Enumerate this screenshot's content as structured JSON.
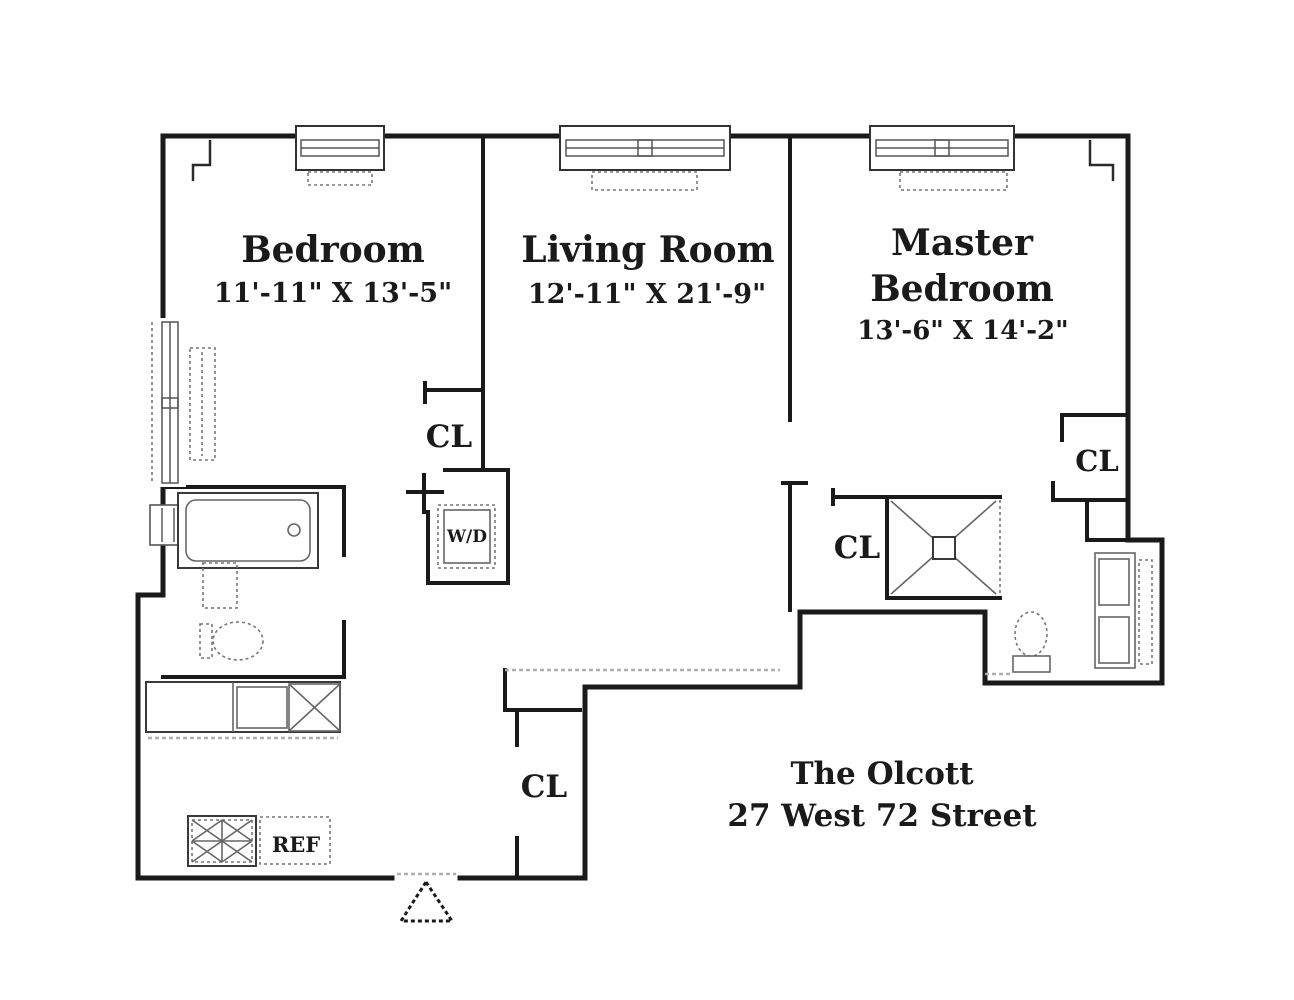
{
  "title": {
    "building_name": "The Olcott",
    "address": "27 West 72 Street"
  },
  "rooms": [
    {
      "name": "Bedroom",
      "dimensions": "11'-11\" X 13'-5\""
    },
    {
      "name": "Living Room",
      "dimensions": "12'-11\" X 21'-9\""
    },
    {
      "name": "Master Bedroom",
      "name_line1": "Master",
      "name_line2": "Bedroom",
      "dimensions": "13'-6\" X 14'-2\""
    }
  ],
  "labels": {
    "bedroom_closet": "CL",
    "hall_closet": "CL",
    "master_closet": "CL",
    "foyer_closet": "CL",
    "washer_dryer": "W/D",
    "refrigerator": "REF"
  },
  "colors": {
    "walls": "#1a1a1a",
    "background": "#ffffff",
    "fixtures": "#555555",
    "thresholds": "#b0b0b0"
  }
}
